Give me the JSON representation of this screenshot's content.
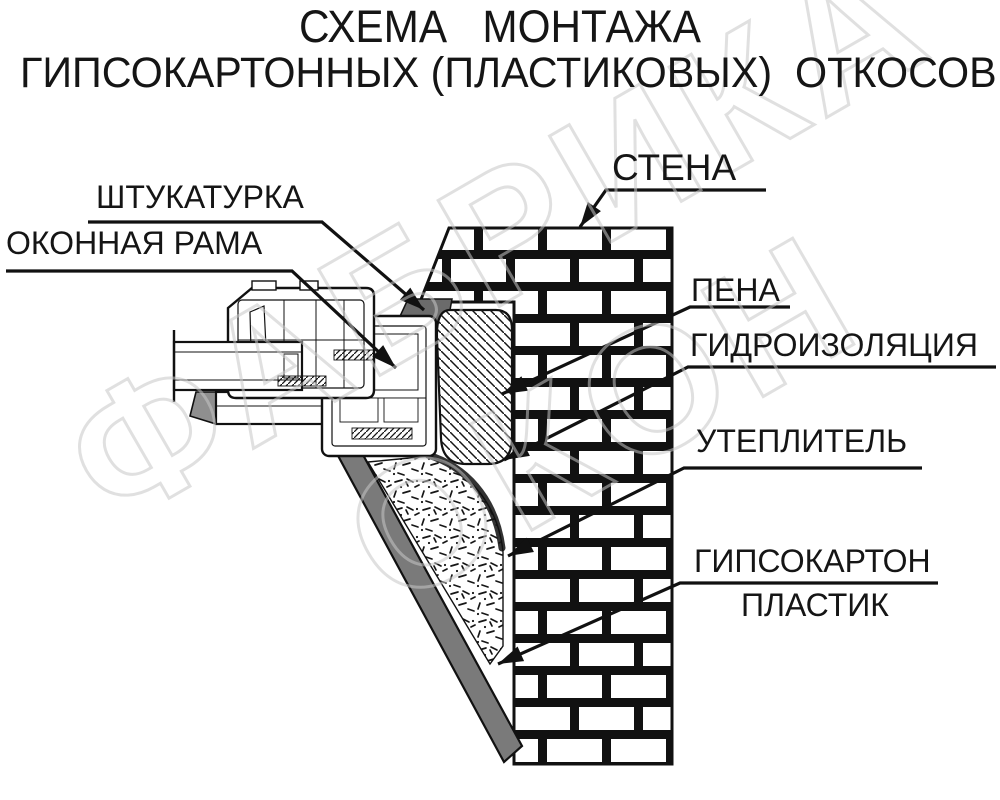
{
  "title": {
    "line1": "СХЕМА   МОНТАЖА",
    "line2": "ГИПСОКАРТОННЫХ (ПЛАСТИКОВЫХ)  ОТКОСОВ"
  },
  "labels": {
    "plaster": "ШТУКАТУРКА",
    "window_frame": "ОКОННАЯ РАМА",
    "wall": "СТЕНА",
    "foam": "ПЕНА",
    "waterproofing": "ГИДРОИЗОЛЯЦИЯ",
    "insulation": "УТЕПЛИТЕЛЬ",
    "drywall": "ГИПСОКАРТОН",
    "plastic": "ПЛАСТИК"
  },
  "watermark": {
    "line1": "ФАБРИКА",
    "line2": "ОКОН"
  },
  "colors": {
    "line": "#111111",
    "plaster_fill": "#6b6b6b",
    "panel_fill": "#7a7a7a",
    "foot_cap_fill": "#8f8f8f",
    "watermark_stroke": "#c7c7c7",
    "background": "#ffffff"
  }
}
